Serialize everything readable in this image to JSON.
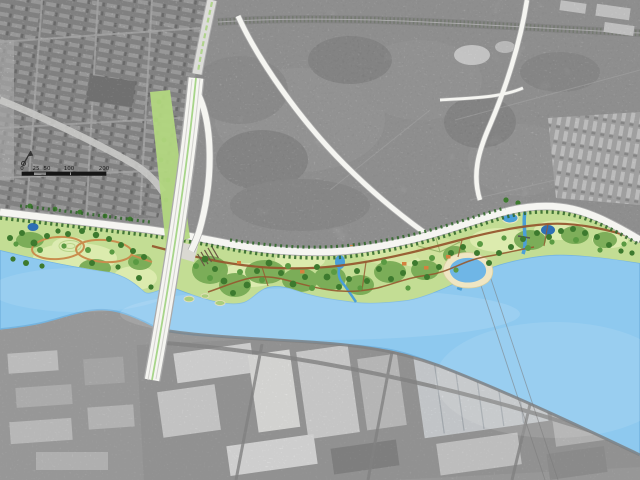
{
  "map": {
    "kind": "riverfront-park-master-plan-over-aerial-photo",
    "scale_bar": {
      "labels": [
        "0",
        "25",
        "50",
        "100",
        "200"
      ]
    },
    "icons": {
      "north_arrow": "north-arrow-icon"
    }
  },
  "colors": {
    "aerial_base": "#c9c9c9",
    "industrial_ground": "#adadad",
    "rail_band": "#979797",
    "bank": "#7f7f7f",
    "water": "#8ec9ef",
    "lawn": "#c3dd94",
    "meadow": "#dcebae",
    "canopy": "#74a852",
    "tree_dark": "#3d7a2e",
    "tree_mid": "#5a9a42",
    "street_tree": "#2e6627",
    "path_brown": "#96592f",
    "path_orange": "#c98e4e",
    "road_fill": "#f5f5f1",
    "road_casing": "#aaaaaa",
    "median_green": "#9fd27d",
    "verge_green": "#b2d780",
    "sand": "#efe6c3",
    "pond": "#4a9fd8",
    "pond_deep": "#2f6fb5",
    "roof_orange": "#d4813f",
    "scale_ink": "#161616"
  }
}
